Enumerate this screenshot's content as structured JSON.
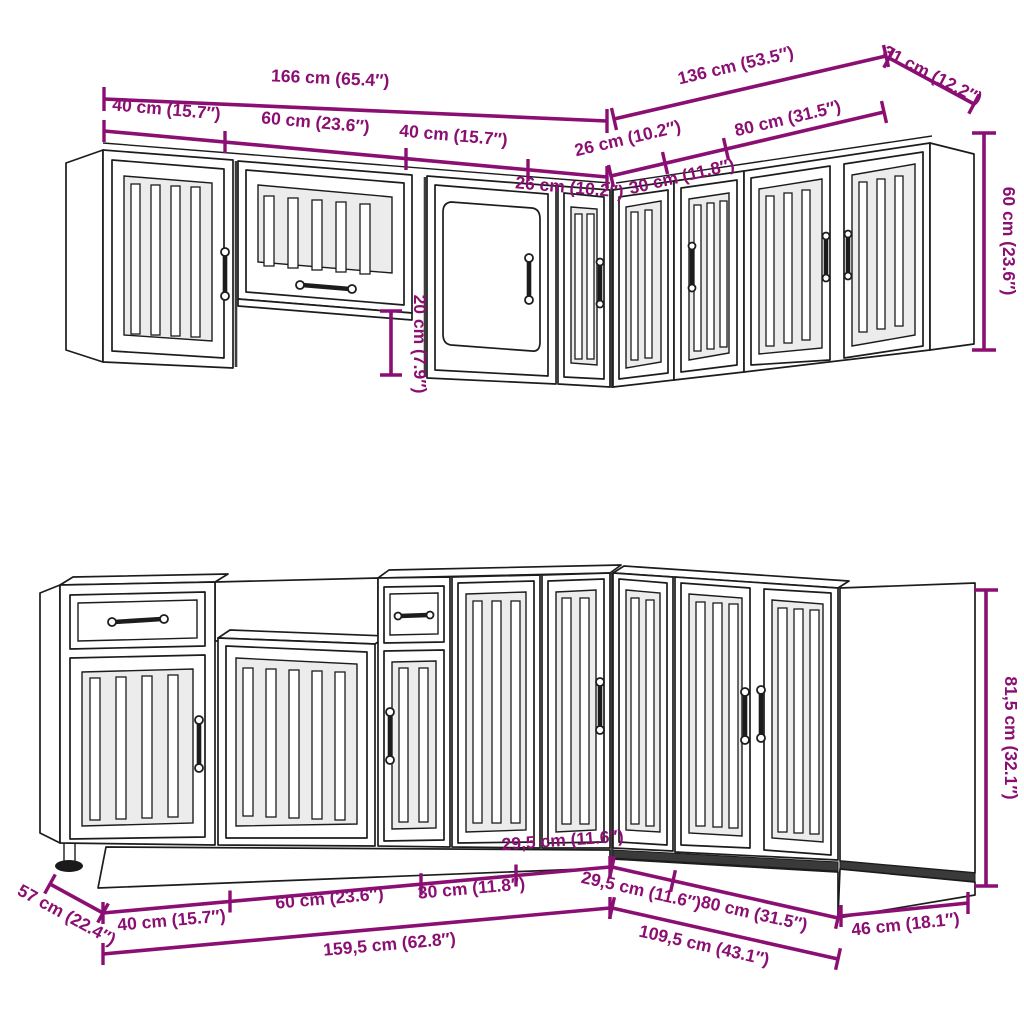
{
  "colors": {
    "dimension": "#8b0f72",
    "line_art": "#1c1c1c"
  },
  "top_section": {
    "description": "wall-cabinets-dimensions",
    "total_left": "166 cm (65.4″)",
    "total_right": "136 cm (53.5″)",
    "depth_right": "31 cm (12.2″)",
    "height": "60 cm (23.6″)",
    "hood_gap": "20 cm (7.9″)",
    "left_segments": [
      "40 cm (15.7″)",
      "60 cm (23.6″)",
      "40 cm (15.7″)",
      "26 cm (10.2″)"
    ],
    "right_segments": [
      "26 cm (10.2″)",
      "30 cm (11.8″)",
      "80 cm (31.5″)"
    ]
  },
  "bottom_section": {
    "description": "base-cabinets-dimensions",
    "depth_left": "57 cm (22.4″)",
    "total_left": "159,5 cm (62.8″)",
    "total_right": "109,5 cm (43.1″)",
    "depth_right": "46 cm (18.1″)",
    "height": "81,5 cm (32.1″)",
    "left_segments": [
      "40 cm (15.7″)",
      "60 cm (23.6″)",
      "30 cm (11.8″)",
      "29,5 cm (11.6″)"
    ],
    "right_segments": [
      "29,5 cm (11.6″)",
      "80 cm (31.5″)"
    ]
  }
}
